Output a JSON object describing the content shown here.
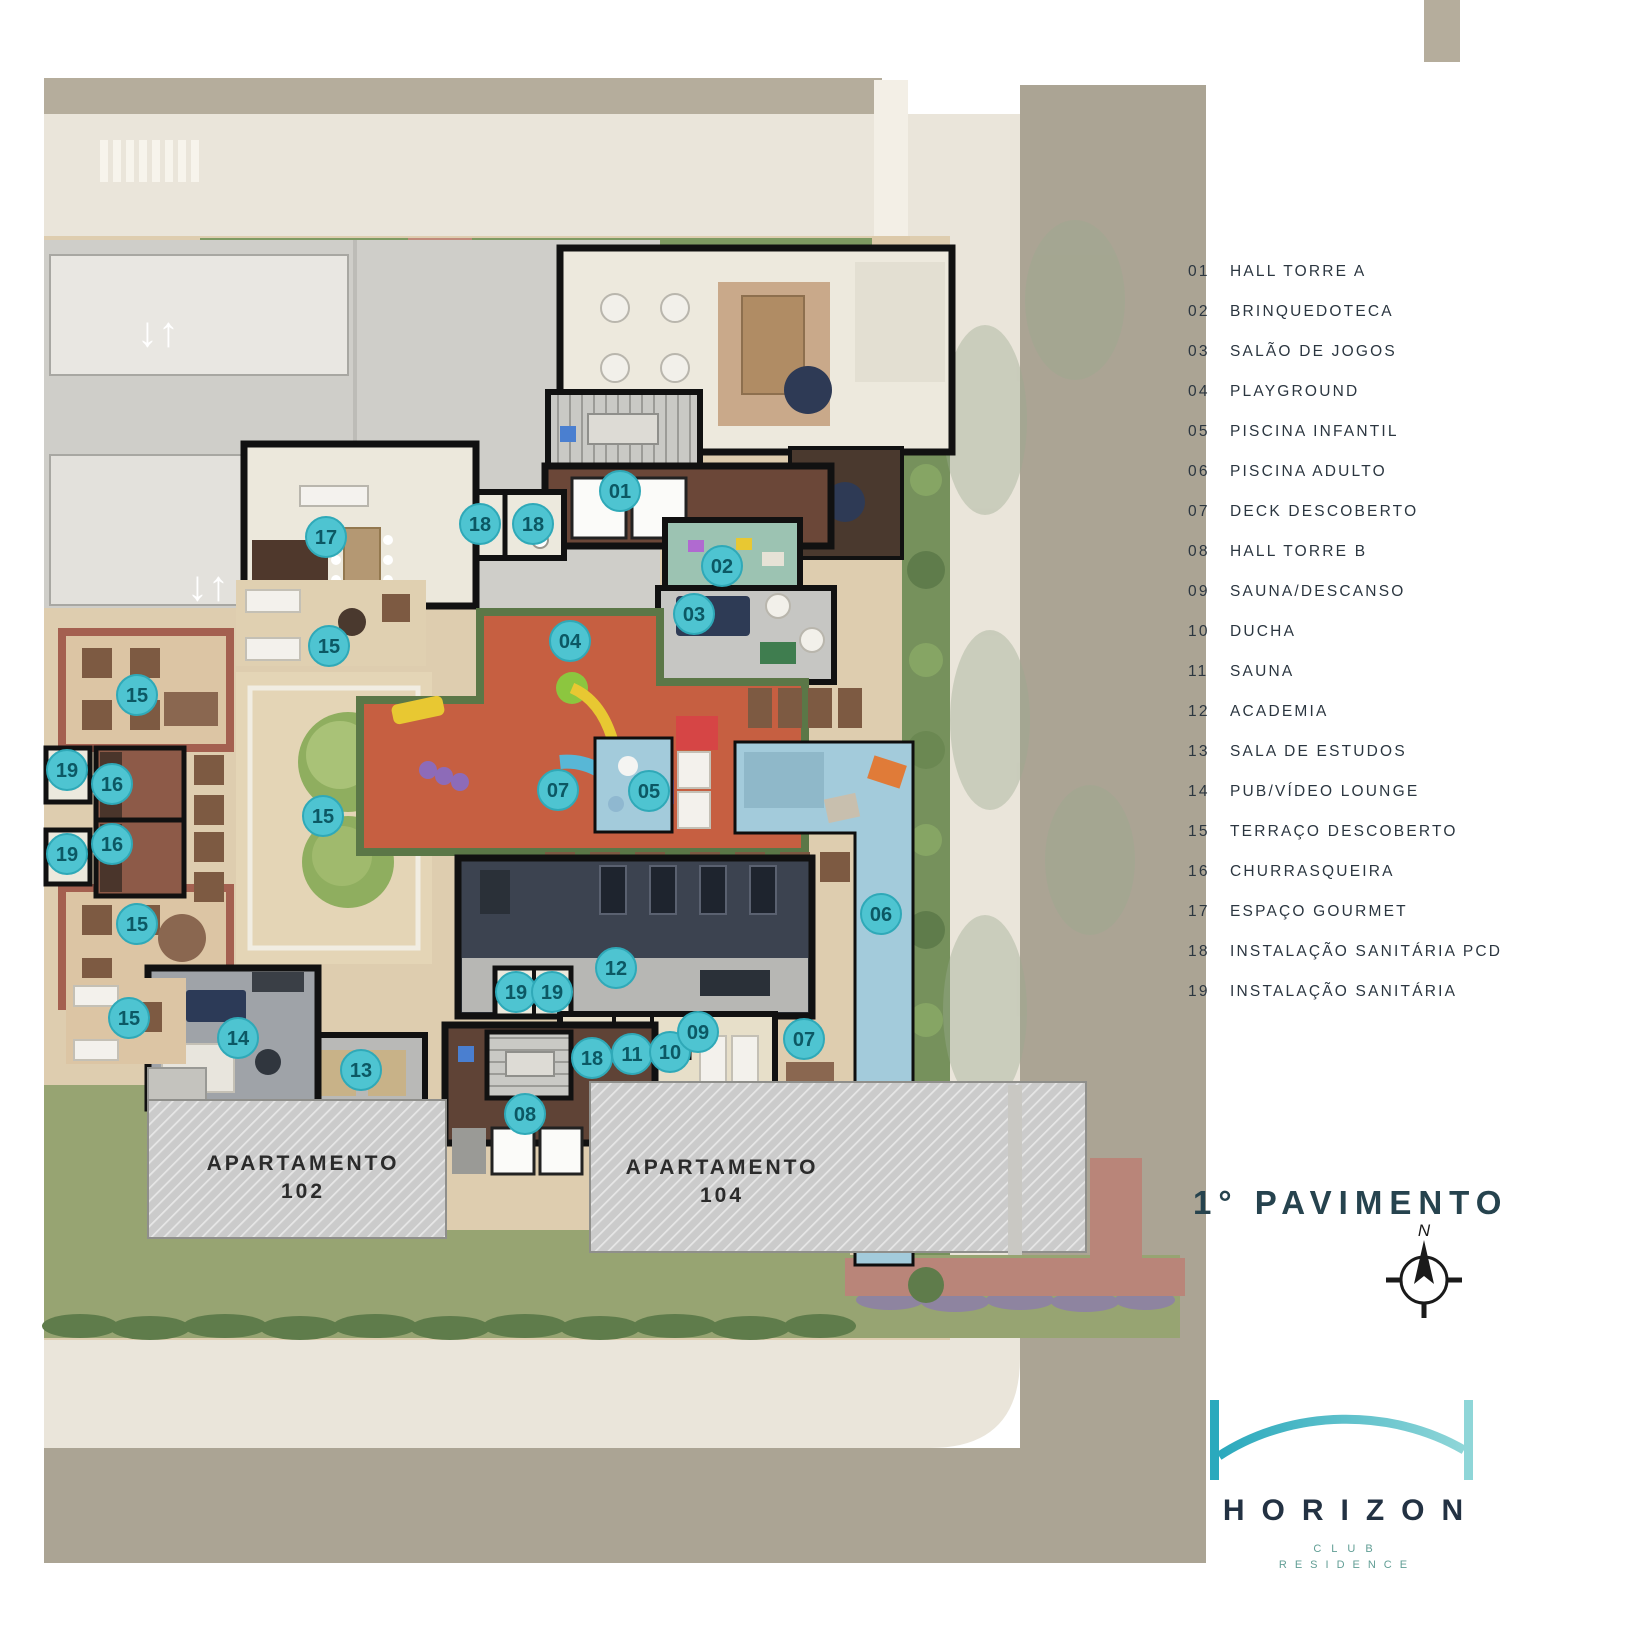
{
  "plan": {
    "title": "1° PAVIMENTO",
    "compass_north": "N",
    "apartments": [
      {
        "line1": "APARTAMENTO",
        "line2": "102"
      },
      {
        "line1": "APARTAMENTO",
        "line2": "104"
      }
    ],
    "markers": [
      {
        "n": "01",
        "x": 620,
        "y": 491
      },
      {
        "n": "18",
        "x": 480,
        "y": 524
      },
      {
        "n": "18",
        "x": 533,
        "y": 524
      },
      {
        "n": "02",
        "x": 722,
        "y": 566
      },
      {
        "n": "03",
        "x": 694,
        "y": 614
      },
      {
        "n": "04",
        "x": 570,
        "y": 641
      },
      {
        "n": "17",
        "x": 326,
        "y": 537
      },
      {
        "n": "15",
        "x": 329,
        "y": 646
      },
      {
        "n": "15",
        "x": 137,
        "y": 695
      },
      {
        "n": "19",
        "x": 67,
        "y": 770
      },
      {
        "n": "16",
        "x": 112,
        "y": 784
      },
      {
        "n": "15",
        "x": 323,
        "y": 816
      },
      {
        "n": "07",
        "x": 558,
        "y": 790
      },
      {
        "n": "05",
        "x": 649,
        "y": 791
      },
      {
        "n": "16",
        "x": 112,
        "y": 844
      },
      {
        "n": "19",
        "x": 67,
        "y": 854
      },
      {
        "n": "06",
        "x": 881,
        "y": 914
      },
      {
        "n": "15",
        "x": 137,
        "y": 924
      },
      {
        "n": "12",
        "x": 616,
        "y": 968
      },
      {
        "n": "19",
        "x": 516,
        "y": 992
      },
      {
        "n": "19",
        "x": 552,
        "y": 992
      },
      {
        "n": "15",
        "x": 129,
        "y": 1018
      },
      {
        "n": "14",
        "x": 238,
        "y": 1038
      },
      {
        "n": "13",
        "x": 361,
        "y": 1070
      },
      {
        "n": "18",
        "x": 592,
        "y": 1058
      },
      {
        "n": "11",
        "x": 632,
        "y": 1054
      },
      {
        "n": "10",
        "x": 670,
        "y": 1052
      },
      {
        "n": "09",
        "x": 698,
        "y": 1032
      },
      {
        "n": "07",
        "x": 804,
        "y": 1039
      },
      {
        "n": "08",
        "x": 525,
        "y": 1114
      }
    ]
  },
  "legend": {
    "items": [
      {
        "num": "01",
        "label": "HALL TORRE A"
      },
      {
        "num": "02",
        "label": "BRINQUEDOTECA"
      },
      {
        "num": "03",
        "label": "SALÃO DE JOGOS"
      },
      {
        "num": "04",
        "label": "PLAYGROUND"
      },
      {
        "num": "05",
        "label": "PISCINA INFANTIL"
      },
      {
        "num": "06",
        "label": "PISCINA ADULTO"
      },
      {
        "num": "07",
        "label": "DECK DESCOBERTO"
      },
      {
        "num": "08",
        "label": "HALL TORRE B"
      },
      {
        "num": "09",
        "label": "SAUNA/DESCANSO"
      },
      {
        "num": "10",
        "label": "DUCHA"
      },
      {
        "num": "11",
        "label": "SAUNA"
      },
      {
        "num": "12",
        "label": "ACADEMIA"
      },
      {
        "num": "13",
        "label": "SALA DE ESTUDOS"
      },
      {
        "num": "14",
        "label": "PUB/VÍDEO LOUNGE"
      },
      {
        "num": "15",
        "label": "TERRAÇO DESCOBERTO"
      },
      {
        "num": "16",
        "label": "CHURRASQUEIRA"
      },
      {
        "num": "17",
        "label": "ESPAÇO GOURMET"
      },
      {
        "num": "18",
        "label": "INSTALAÇÃO SANITÁRIA PCD"
      },
      {
        "num": "19",
        "label": "INSTALAÇÃO SANITÁRIA"
      }
    ]
  },
  "logo": {
    "name": "HORIZON",
    "sub1": "CLUB",
    "sub2": "RESIDENCE"
  },
  "colors": {
    "marker_fill": "#4ec4d1",
    "marker_stroke": "#2fa9b8",
    "marker_text": "#0c5864",
    "legend_text": "#2b3640",
    "title_text": "#26434e",
    "logo_teal": "#2aa9bd",
    "logo_teal_light": "#8fd6d8",
    "logo_navy": "#233243",
    "pool_blue": "#a3cbdb",
    "playground_red": "#c65f41",
    "lawn_green": "#95a470",
    "road_taupe": "#aba494",
    "sidewalk_beige": "#eae5da"
  }
}
